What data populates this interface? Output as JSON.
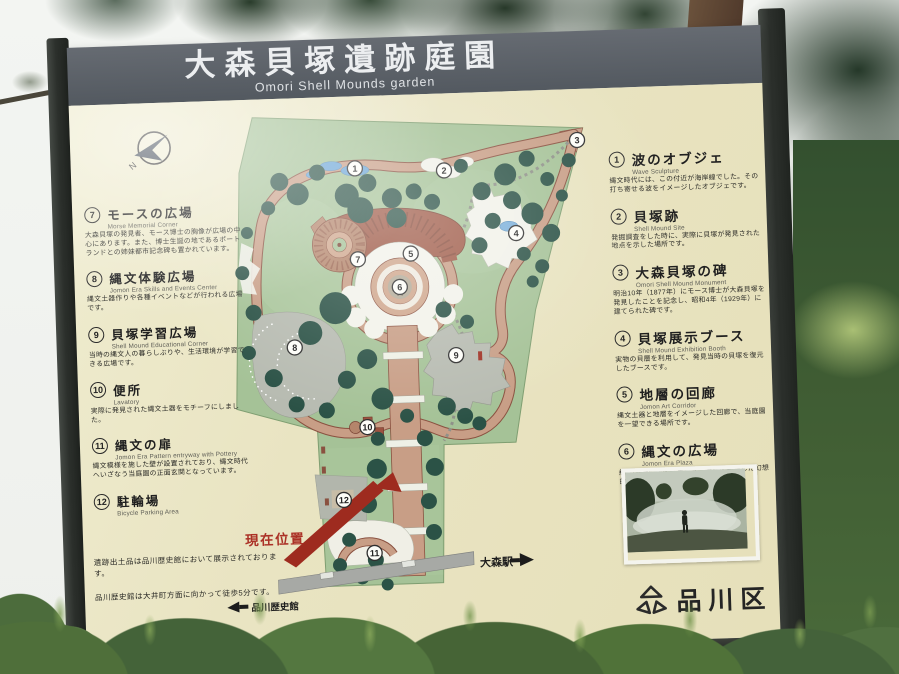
{
  "sign": {
    "title": "大森貝塚遺跡庭園",
    "subtitle": "Omori Shell Mounds garden"
  },
  "legend_left": {
    "items": [
      {
        "num": "7",
        "title": "モースの広場",
        "subtitle": "Morse Memorial Corner",
        "desc": "大森貝塚の発見者、モース博士の胸像が広場の中心にあります。また、博士生誕の地であるポートランドとの姉妹都市記念碑も置かれています。"
      },
      {
        "num": "8",
        "title": "縄文体験広場",
        "subtitle": "Jomon Era Skills and Events Center",
        "desc": "縄文土器作りや各種イベントなどが行われる広場です。"
      },
      {
        "num": "9",
        "title": "貝塚学習広場",
        "subtitle": "Shell Mound Educational Corner",
        "desc": "当時の縄文人の暮らしぶりや、生活環境が学習できる広場です。"
      },
      {
        "num": "10",
        "title": "便所",
        "subtitle": "Lavatory",
        "desc": "実際に発見された縄文土器をモチーフにしました。"
      },
      {
        "num": "11",
        "title": "縄文の扉",
        "subtitle": "Jomon Era Pattern entryway with Pottery",
        "desc": "縄文模様を施した壁が設置されており、縄文時代へいざなう当庭園の正面玄関となっています。"
      },
      {
        "num": "12",
        "title": "駐輪場",
        "subtitle": "Bicycle Parking Area",
        "desc": ""
      }
    ]
  },
  "legend_right": {
    "items": [
      {
        "num": "1",
        "title": "波のオブジェ",
        "subtitle": "Wave Sculpture",
        "desc": "縄文時代には、この付近が海岸線でした。その打ち寄せる波をイメージしたオブジェです。"
      },
      {
        "num": "2",
        "title": "貝塚跡",
        "subtitle": "Shell Mound Site",
        "desc": "発掘調査をした時に、実際に貝塚が発見された地点を示した場所です。"
      },
      {
        "num": "3",
        "title": "大森貝塚の碑",
        "subtitle": "Omori Shell Mound Monument",
        "desc": "明治10年（1877年）にモース博士が大森貝塚を発見したことを記念し、昭和4年（1929年）に建てられた碑です。"
      },
      {
        "num": "4",
        "title": "貝塚展示ブース",
        "subtitle": "Shell Mound Exhibition Booth",
        "desc": "実物の貝層を利用して、発見当時の貝塚を復元したブースです。"
      },
      {
        "num": "5",
        "title": "地層の回廊",
        "subtitle": "Jomon Art Corridor",
        "desc": "縄文土器と地層をイメージした回廊で、当庭園を一望できる場所です。"
      },
      {
        "num": "6",
        "title": "縄文の広場",
        "subtitle": "Jomon Era Plaza",
        "desc": "約30分毎に霧を発生させ、時間を超越した幻想的な空間を演出しています。"
      }
    ]
  },
  "map": {
    "markers": [
      {
        "n": "1",
        "x": 146,
        "y": 61
      },
      {
        "n": "2",
        "x": 235,
        "y": 66
      },
      {
        "n": "3",
        "x": 369,
        "y": 40
      },
      {
        "n": "4",
        "x": 305,
        "y": 131
      },
      {
        "n": "5",
        "x": 199,
        "y": 148
      },
      {
        "n": "6",
        "x": 187,
        "y": 181
      },
      {
        "n": "7",
        "x": 146,
        "y": 152
      },
      {
        "n": "8",
        "x": 80,
        "y": 238
      },
      {
        "n": "9",
        "x": 241,
        "y": 251
      },
      {
        "n": "10",
        "x": 150,
        "y": 320
      },
      {
        "n": "11",
        "x": 153,
        "y": 446
      },
      {
        "n": "12",
        "x": 124,
        "y": 392
      }
    ],
    "current_location_label": "現在位置",
    "station_label": "大森駅",
    "museum_label": "品川歴史館",
    "compass_label": "N"
  },
  "notes": {
    "note1": "遺跡出土品は品川歴史館において展示されております。",
    "note2": "品川歴史館は大井町方面に向かって徒歩5分です。"
  },
  "footer": {
    "ward_label": "品川区"
  },
  "colors": {
    "board_bg": "#e9e4c2",
    "title_band": "#565b62",
    "park_green": "#a5c297",
    "tree_green": "#2b5246",
    "path_salmon": "#c89e86",
    "path_brown": "#8a5140",
    "corridor_brown": "#9e5946",
    "plaza_gray": "#b7bbb1",
    "water_blue": "#6aa4d6",
    "current_red": "#9e2b1f",
    "road_gray": "#a7a9a5"
  }
}
